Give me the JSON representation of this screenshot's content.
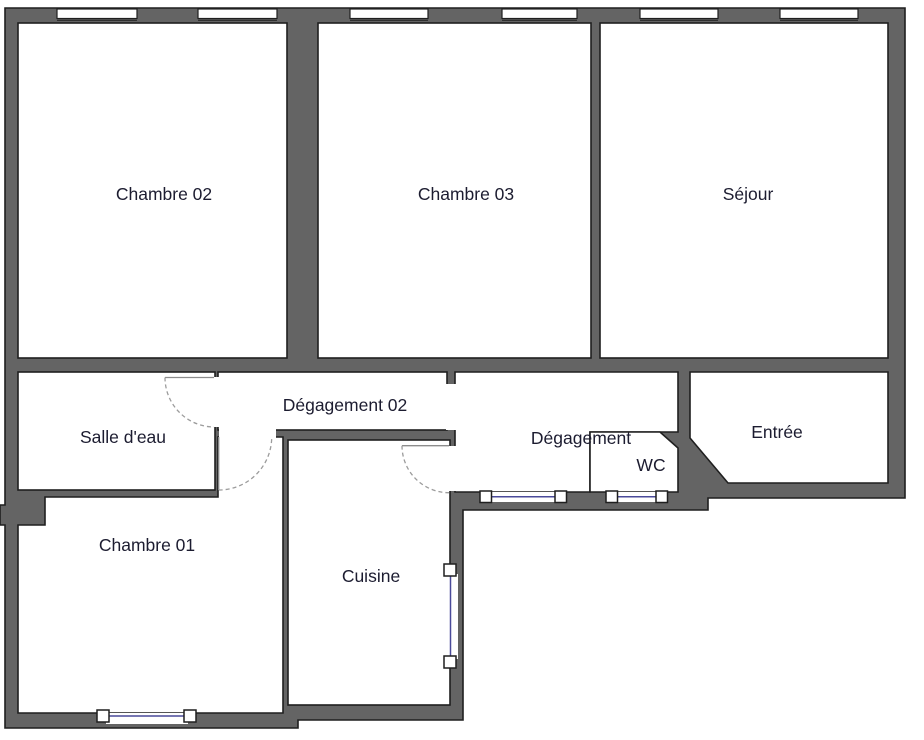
{
  "plan_title": "Floor plan",
  "colors": {
    "wall": "#646464",
    "outline": "#1f1f1f",
    "room_fill": "#ffffff",
    "window_line": "#4a4a9a",
    "door_arc": "#9c9c9c",
    "door_leaf": "#8c8c8c",
    "label": "#1c1c30"
  },
  "rooms": {
    "chambre02": {
      "label": "Chambre 02"
    },
    "chambre03": {
      "label": "Chambre 03"
    },
    "sejour": {
      "label": "Séjour"
    },
    "salle_deau": {
      "label": "Salle d'eau"
    },
    "degagement02": {
      "label": "Dégagement 02"
    },
    "degagement": {
      "label": "Dégagement"
    },
    "wc": {
      "label": "WC"
    },
    "entree": {
      "label": "Entrée"
    },
    "chambre01": {
      "label": "Chambre 01"
    },
    "cuisine": {
      "label": "Cuisine"
    }
  }
}
